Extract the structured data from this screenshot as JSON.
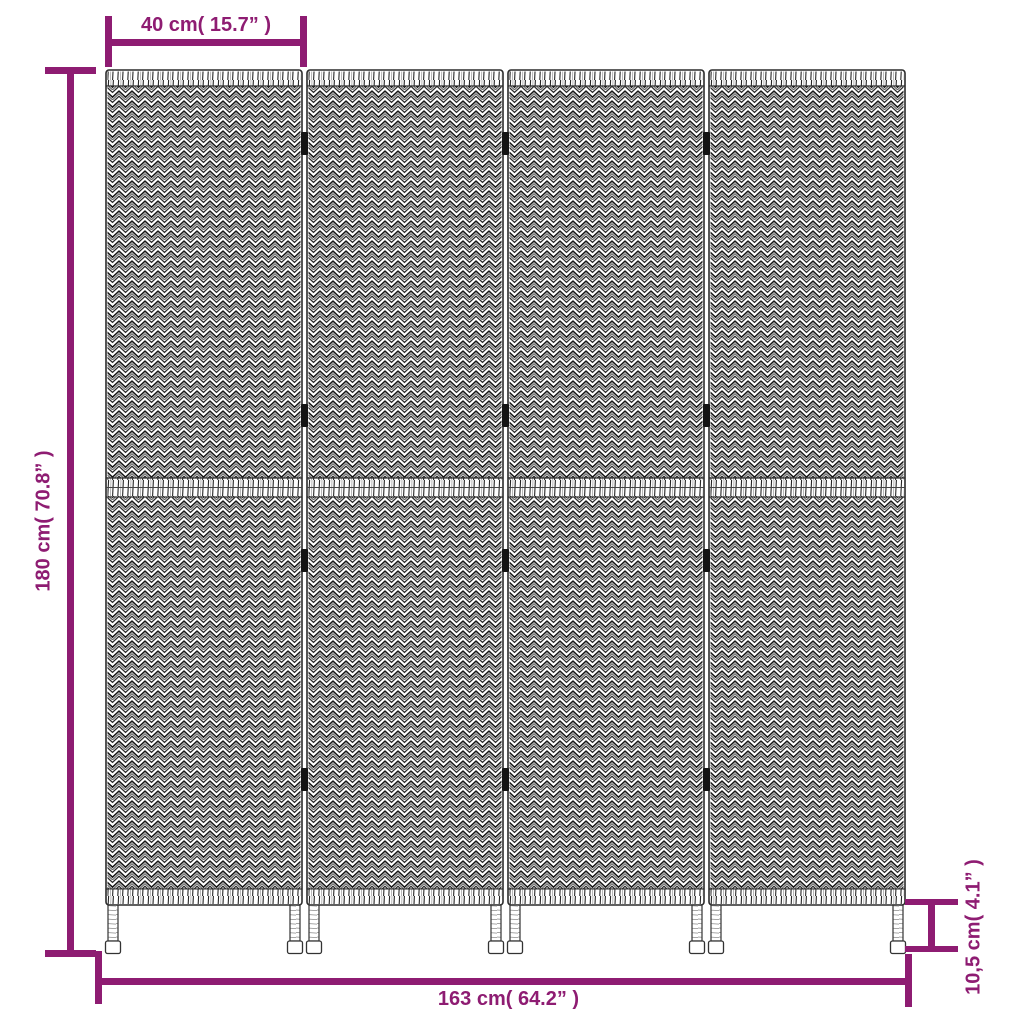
{
  "figure": {
    "kind": "product-dimension-diagram",
    "subject": "4-panel woven room divider",
    "panel_count": 4,
    "accent_color": "#8E1C72",
    "line_art_color": "#262626",
    "background_color": "#ffffff"
  },
  "dimensions": {
    "panel_width": "40 cm( 15.7” )",
    "height": "180 cm( 70.8” )",
    "total_width": "163 cm( 64.2” )",
    "foot_height": "10,5 cm( 4.1” )"
  }
}
